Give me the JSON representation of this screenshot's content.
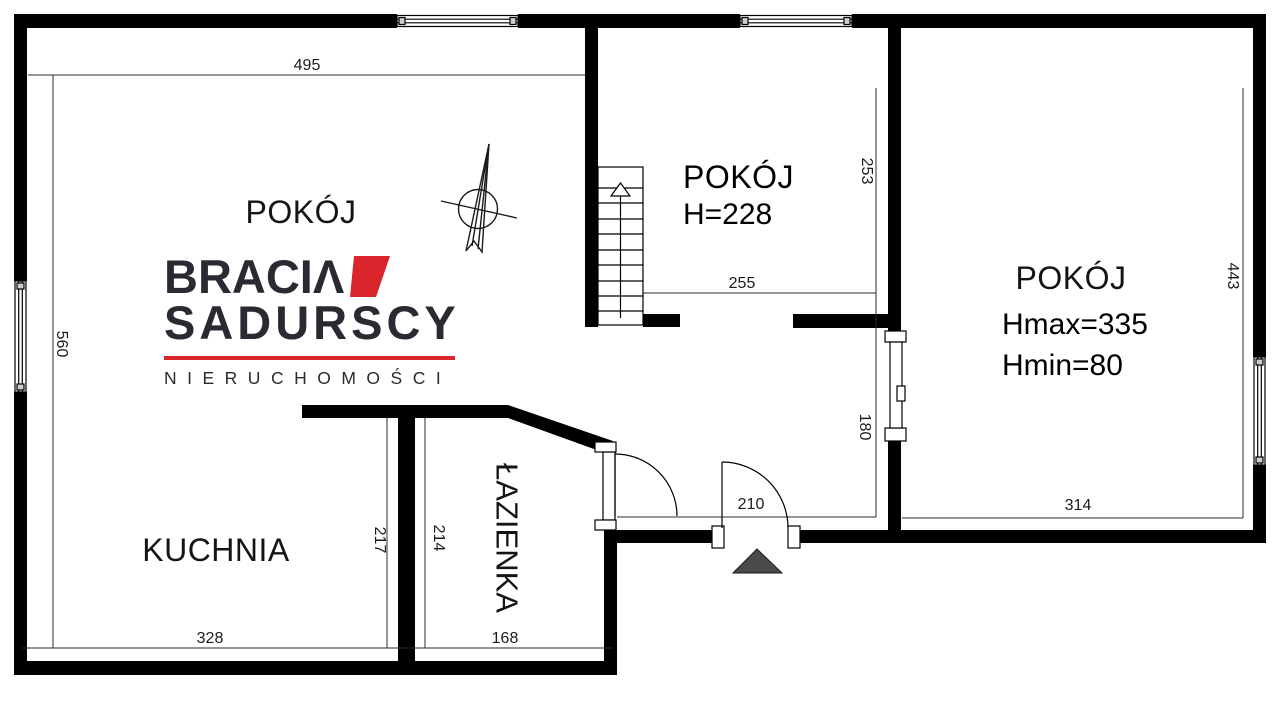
{
  "plan": {
    "rooms": {
      "room_left": {
        "label": "POKÓJ"
      },
      "room_middle": {
        "label": "POKÓJ",
        "height_note": "H=228"
      },
      "room_right": {
        "label": "POKÓJ",
        "hmax_note": "Hmax=335",
        "hmin_note": "Hmin=80"
      },
      "kitchen": {
        "label": "KUCHNIA"
      },
      "bathroom": {
        "label": "ŁAZIENKA"
      }
    },
    "dimensions": {
      "top_width": "495",
      "left_height": "560",
      "middle_room_height": "253",
      "middle_room_width": "255",
      "right_room_height": "443",
      "right_room_width": "314",
      "hall_width": "210",
      "hall_window_height": "180",
      "kitchen_height": "217",
      "bathroom_height": "214",
      "kitchen_width": "328",
      "bathroom_width": "168"
    }
  },
  "brand": {
    "name_line1": "BRACIΛ",
    "name_line2": "SADURSCY",
    "tagline": "NIERUCHOMOŚCI",
    "accent_color": "#D9252B",
    "text_color": "#2A2A33"
  },
  "colors": {
    "wall": "#000000",
    "entrance_marker": "#4A4A4A",
    "dimension_line": "#2B2B2B"
  }
}
